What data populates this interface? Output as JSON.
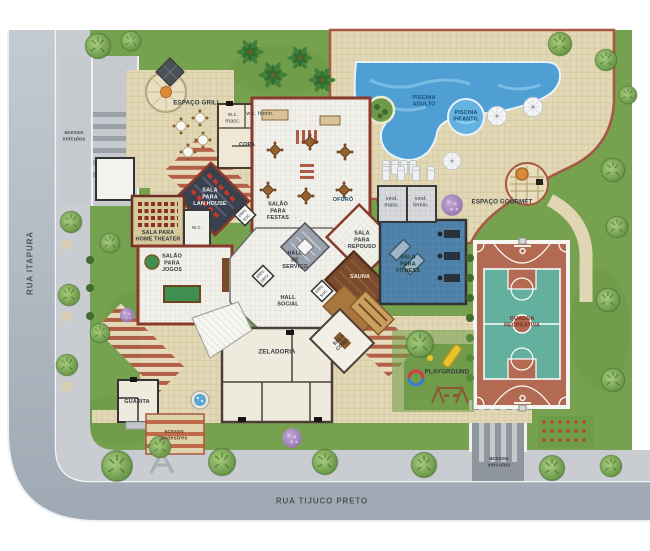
{
  "streets": {
    "left": "RUA ITAPURA",
    "bottom": "RUA TIJUCO PRETO"
  },
  "access": {
    "vehicles": "acesso\nveículos",
    "pedestrians": "acesso\npedestres"
  },
  "leisure": {
    "grill": "ESPAÇO GRILL",
    "pool_adult": "PISCINA\nADULTO",
    "pool_kids": "PISCINA\nINFANTIL",
    "gourmet": "ESPAÇO GOURMET",
    "ofuro": "OFURÔ",
    "playground": "PLAYGROUND",
    "court": "QUADRA\nRECREATIVA"
  },
  "rooms": {
    "copa": "COPA",
    "wc_masc": "w.c.\nmasc.",
    "wc_fem": "w.c. femin.",
    "wc": "w.c.",
    "party_hall": "SALÃO\nPARA\nFESTAS",
    "lan_house": "SALA\nPARA\nLAN HOUSE",
    "home_theater": "SALA PARA\nHOME THEATER",
    "games_hall": "SALÃO\nPARA\nJOGOS",
    "service_hall": "HALL\nDE\nSERVIÇO",
    "social_hall": "HALL\nSOCIAL",
    "elev_social": "elev.\nsoc.",
    "elev_service": "elev.\nserv.",
    "rest_room": "SALA\nPARA\nREPOUSO",
    "sauna": "SAUNA",
    "fitness": "SALA\nPARA\nFITNESS",
    "vest_masc": "vest.\nmasc.",
    "vest_fem": "vest.\nfemin.",
    "caretaker": "ZELADORIA",
    "condo_room": "SALA\nCOND.",
    "guardhouse": "GUARITA"
  },
  "colors": {
    "street": "#b7c0c9",
    "sidewalk": "#c9cdd2",
    "lawn": "#76a14e",
    "paver": "#e2d8b5",
    "pool": "#4f9fd4",
    "pool_kids": "#63b2df",
    "court_floor": "#63b09e",
    "court_apron": "#b26a52",
    "wall_red": "#8a3a2c",
    "fitness_floor": "#4e7fa6",
    "sauna_wood": "#7a4a2e",
    "lan_floor": "#39414f"
  }
}
